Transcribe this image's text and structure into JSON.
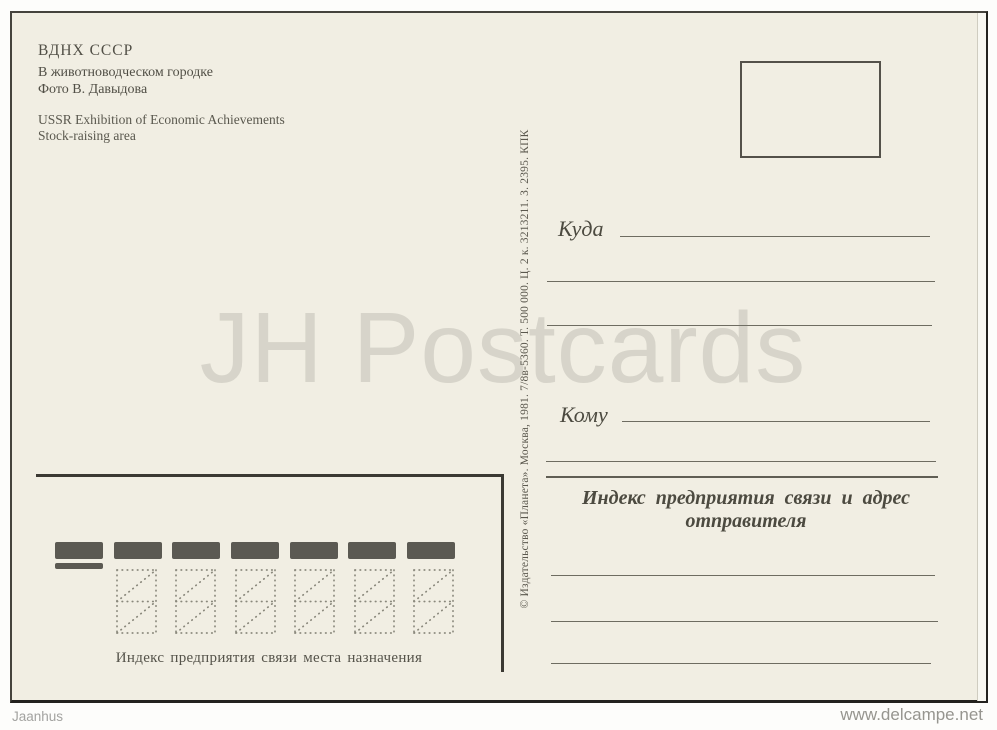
{
  "postcard": {
    "header": {
      "title_ru": "ВДНХ СССР",
      "caption_ru": "В животноводческом городке",
      "photo_credit_ru": "Фото В. Давыдова",
      "title_en": "USSR Exhibition of Economic Achievements",
      "caption_en": "Stock-raising area"
    },
    "imprint_vertical": "© Издательство «Планета». Москва, 1981. 7/8в-5360. Т. 500 000. Ц. 2 к. 3213211. З. 2395. КПК",
    "address": {
      "to_where_label": "Куда",
      "to_whom_label": "Кому",
      "sender_heading_line1": "Индекс предприятия связи и адрес",
      "sender_heading_line2": "отправителя"
    },
    "index_zone": {
      "caption": "Индекс предприятия связи места назначения"
    }
  },
  "watermark_text": "JH Postcards",
  "overlay": {
    "bottom_left": "Jaanhus",
    "bottom_right": "www.delcampe.net"
  },
  "colors": {
    "card_background": "#f1eee3",
    "ink": "#4e4b41",
    "rule_line": "#6e6c61",
    "index_bar": "#5b5952",
    "frame": "#3b3933",
    "watermark": "#d9d7cf"
  }
}
